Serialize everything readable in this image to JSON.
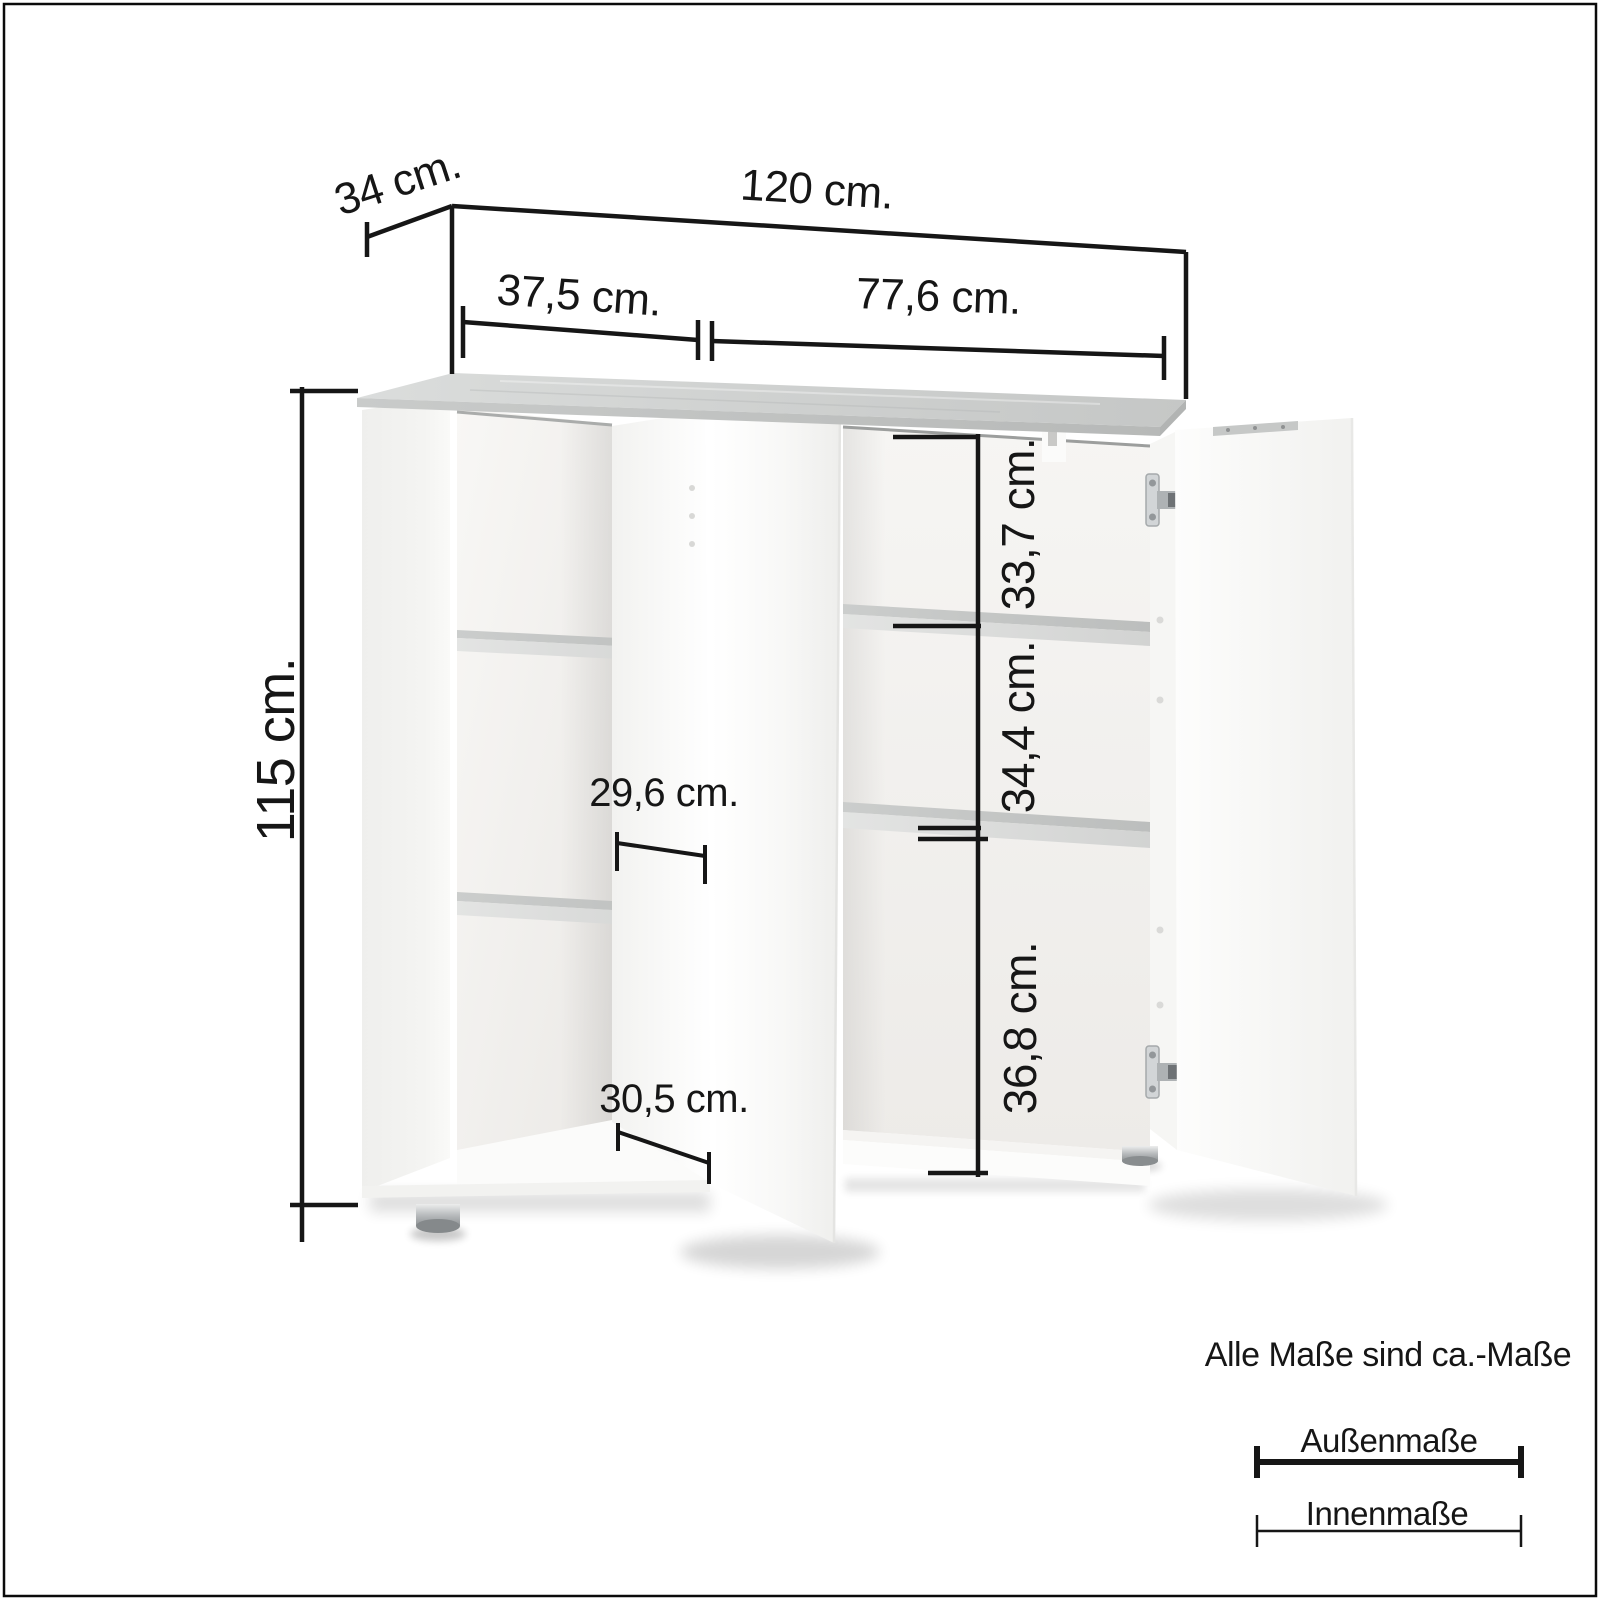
{
  "dimensions": {
    "depth": "34 cm.",
    "total_width": "120 cm.",
    "left_width": "37,5 cm.",
    "right_width": "77,6 cm.",
    "total_height": "115 cm.",
    "right_top_height": "33,7 cm.",
    "right_middle_height": "34,4 cm.",
    "right_bottom_height": "36,8 cm.",
    "left_upper_inner_width": "29,6 cm.",
    "left_lower_inner_width": "30,5 cm."
  },
  "legend": {
    "note": "Alle Maße sind ca.-Maße",
    "outer_label": "Außenmaße",
    "inner_label": "Innenmaße"
  },
  "colors": {
    "line": "#161616",
    "concrete_top": "#cdcfce",
    "cabinet_white": "#ffffff",
    "metal": "#c2c5c7",
    "background": "#ffffff"
  }
}
